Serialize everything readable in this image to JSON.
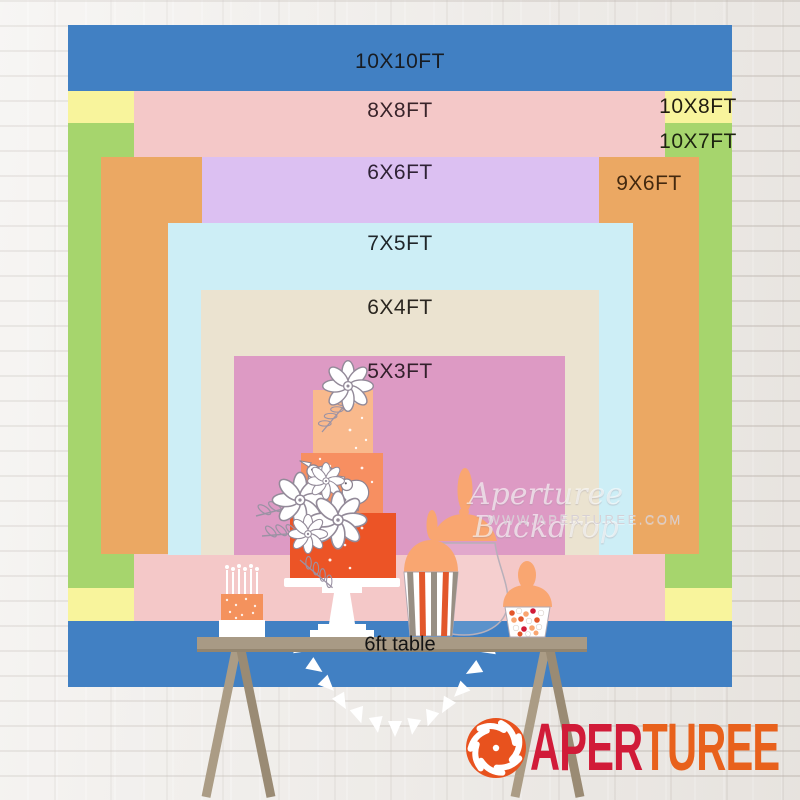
{
  "backdrop_sizes": {
    "s10x10": {
      "label": "10X10FT",
      "color": "#4180c3"
    },
    "s10x8": {
      "label": "10X8FT",
      "color": "#f8f49c"
    },
    "s10x7": {
      "label": "10X7FT",
      "color": "#a6d56d"
    },
    "s8x8": {
      "label": "8X8FT",
      "color": "#f4c8c8"
    },
    "s9x6": {
      "label": "9X6FT",
      "color": "#eba863"
    },
    "s6x6": {
      "label": "6X6FT",
      "color": "#dcc0f2"
    },
    "s7x5": {
      "label": "7X5FT",
      "color": "#cdeef6"
    },
    "s6x4": {
      "label": "6X4FT",
      "color": "#ebe3d0"
    },
    "s5x3": {
      "label": "5X3FT",
      "color": "#dd9ac4"
    }
  },
  "table": {
    "label": "6ft table"
  },
  "watermark": {
    "brand_script": "Aperturee Backdrop",
    "website": "WWW.APERTUREE.COM"
  },
  "logo": {
    "name_part1": "APER",
    "name_part2": "TUREE",
    "color_part1": "#d11b38",
    "color_part2": "#e8611c",
    "icon_color": "#e8521e"
  }
}
